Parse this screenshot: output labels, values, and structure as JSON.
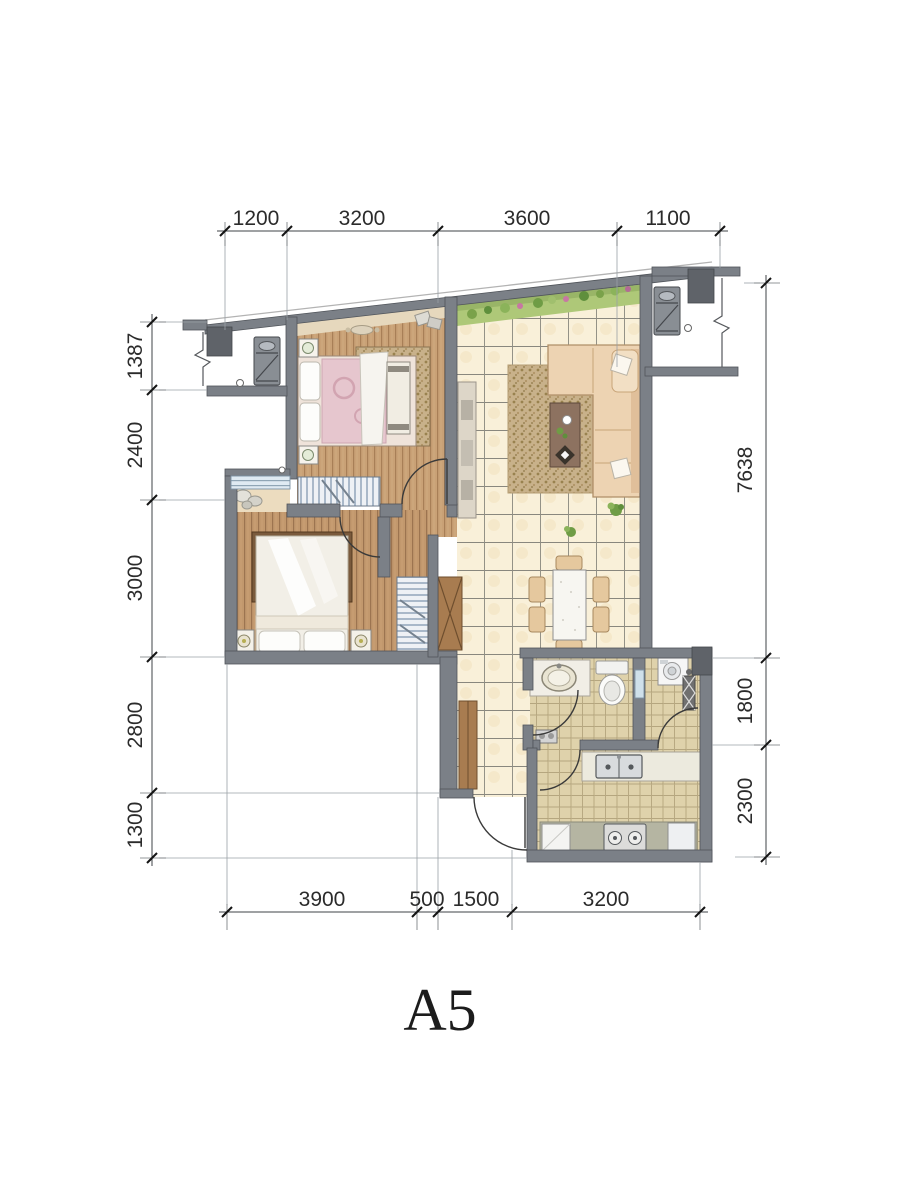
{
  "plan": {
    "unit_label": "A5"
  },
  "dimensions": {
    "top": [
      "1200",
      "3200",
      "3600",
      "1100"
    ],
    "left": [
      "1387",
      "2400",
      "3000",
      "2800",
      "1300"
    ],
    "right": [
      "7638",
      "1800",
      "2300"
    ],
    "bottom": [
      "3900",
      "500",
      "1500",
      "3200"
    ]
  },
  "colors": {
    "wall": "#7b8087",
    "wall_dark": "#5f6369",
    "wood_floor": "#c6a076",
    "tile_floor": "#f8efd8",
    "small_tile_floor": "#dfd2ab",
    "planter_green": "#aec878",
    "sofa_beige": "#edd3b2",
    "window_blue": "#cfe0ea",
    "dimension_text": "#2b2b2b"
  }
}
